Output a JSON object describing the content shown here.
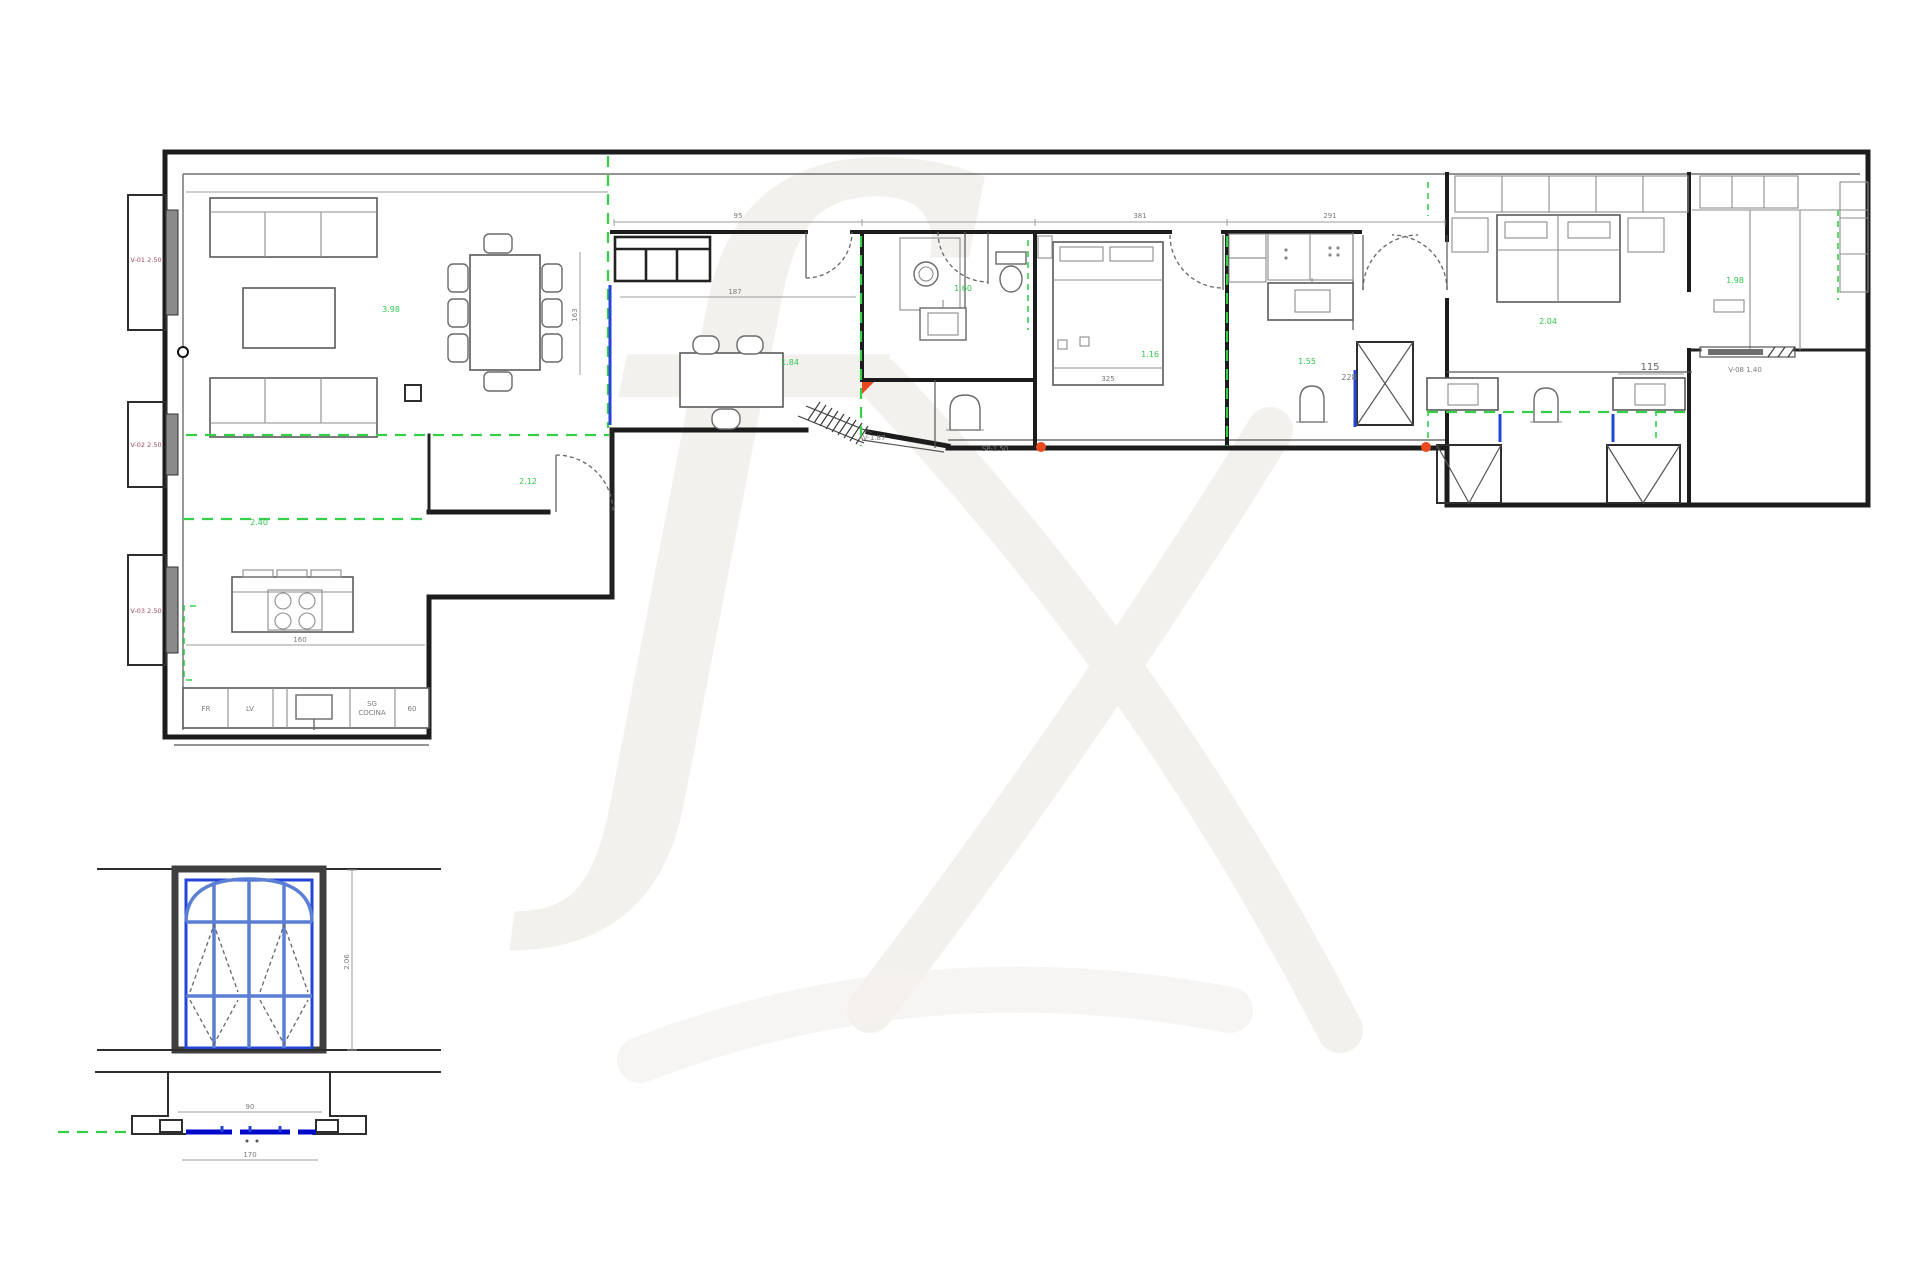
{
  "title": "Planta amueblada",
  "colors": {
    "wall": "#1c1c1c",
    "furniture": "#5a5a5a",
    "dimension": "#9b9b9b",
    "guide_green": "#35d04a",
    "glazing_blue": "#2446d6",
    "sill_blue": "#0009c8",
    "frame_blue": "#5b7fd4",
    "marker_red": "#e8491d",
    "watermark": "#f3f1ee"
  },
  "windows": {
    "win1": "V-01 2.50",
    "win2": "V-02 2.50",
    "win3": "V-03 2.50"
  },
  "dimensions": {
    "top_a": "95",
    "top_b": "381",
    "top_c": "291",
    "study_w": "187",
    "dining_h": "163",
    "kitchen_w": "160",
    "bed1": "325",
    "vanity": "115",
    "hall": "228",
    "detail_h": "2.06",
    "detail_w1": "90",
    "detail_w2": "170"
  },
  "annotations": {
    "ramp": "AV-1.87",
    "step": "SP-1.50",
    "door": "V-08 1.40"
  },
  "areas": {
    "living": "3.98",
    "entry": "2.12",
    "study": "1.84",
    "bath1": "1.60",
    "hall": "1.16",
    "bath2": "1.55",
    "bed2": "2.04",
    "room3": "1.98",
    "kitchen": "2.40"
  },
  "kitchen_units": {
    "u1": "FR",
    "u2": "LV",
    "u3": "SG",
    "u4": "COCINA",
    "u5": "60"
  }
}
